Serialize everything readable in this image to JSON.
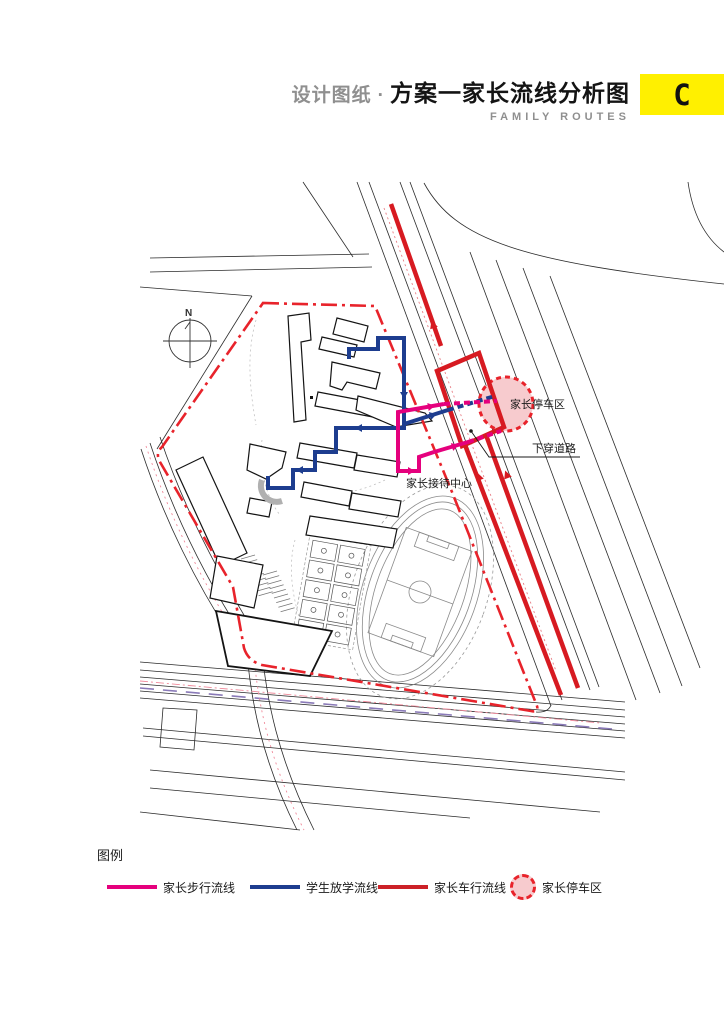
{
  "header": {
    "title_prefix": "设计图纸",
    "title_separator": "·",
    "title_main": "方案一家长流线分析图",
    "subtitle": "FAMILY ROUTES",
    "sheet_code": "C"
  },
  "colors": {
    "accent_yellow": "#FFF000",
    "route_drive_red": "#d71a21",
    "boundary_red": "#e8232b",
    "route_student_blue": "#1d3d8f",
    "route_walk_magenta": "#e5007d",
    "parking_fill_pink": "#f7cbce",
    "metro_purple": "#8a7ab8",
    "road_black": "#2b2b2b"
  },
  "map": {
    "labels": {
      "parking_area": "家长停车区",
      "underpass_road": "下穿道路",
      "reception_center": "家长接待中心",
      "north": "N"
    }
  },
  "legend": {
    "title": "图例",
    "items": [
      {
        "label": "家长步行流线",
        "type": "line",
        "color": "#e5007d",
        "left": 10
      },
      {
        "label": "学生放学流线",
        "type": "line",
        "color": "#1d3d8f",
        "left": 153
      },
      {
        "label": "家长车行流线",
        "type": "line",
        "color": "#cc2127",
        "left": 281
      },
      {
        "label": "家长停车区",
        "type": "circle",
        "color": "#e8232b",
        "fill": "#f7cbce",
        "left": 413
      }
    ]
  }
}
